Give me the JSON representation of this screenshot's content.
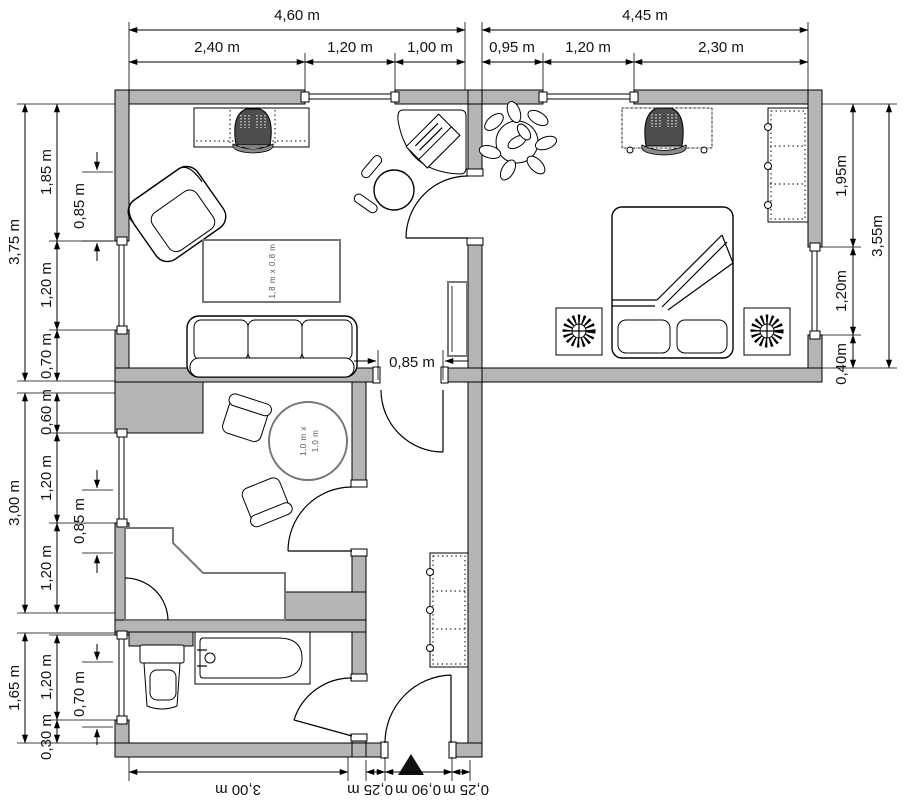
{
  "plan": {
    "type": "apartment-floor-plan",
    "units": "meters",
    "colors": {
      "wall": "#b5b5b5",
      "line": "#000000",
      "tv": "#4d4d4d",
      "background": "#ffffff"
    }
  },
  "dims": {
    "top_overall": [
      "4,60 m",
      "4,45 m"
    ],
    "top_segs": [
      "2,40 m",
      "1,20 m",
      "1,00 m",
      "0,95 m",
      "1,20 m",
      "2,30 m"
    ],
    "left_overall": [
      "3,75 m",
      "3,00 m",
      "1,65 m"
    ],
    "left_segs": [
      "1,85 m",
      "1,20 m",
      "0,70 m",
      "0,60 m",
      "1,20 m",
      "1,20 m",
      "1,20 m",
      "0,30 m"
    ],
    "left_inner": [
      "0,85 m",
      "0,85 m",
      "0,70 m"
    ],
    "right_segs": [
      "1,95m",
      "1,20m",
      "0,40m"
    ],
    "right_overall": [
      "3,55m"
    ],
    "bottom_segs": [
      "3,00 m",
      "0,25 m",
      "0,90 m",
      "0,25 m"
    ],
    "door_living_hall": "0,85 m"
  },
  "labels": {
    "living_table": "1,8 m x 0,8 m",
    "kitchen_table_line1": "1,0 m x",
    "kitchen_table_line2": "1,0 m"
  }
}
